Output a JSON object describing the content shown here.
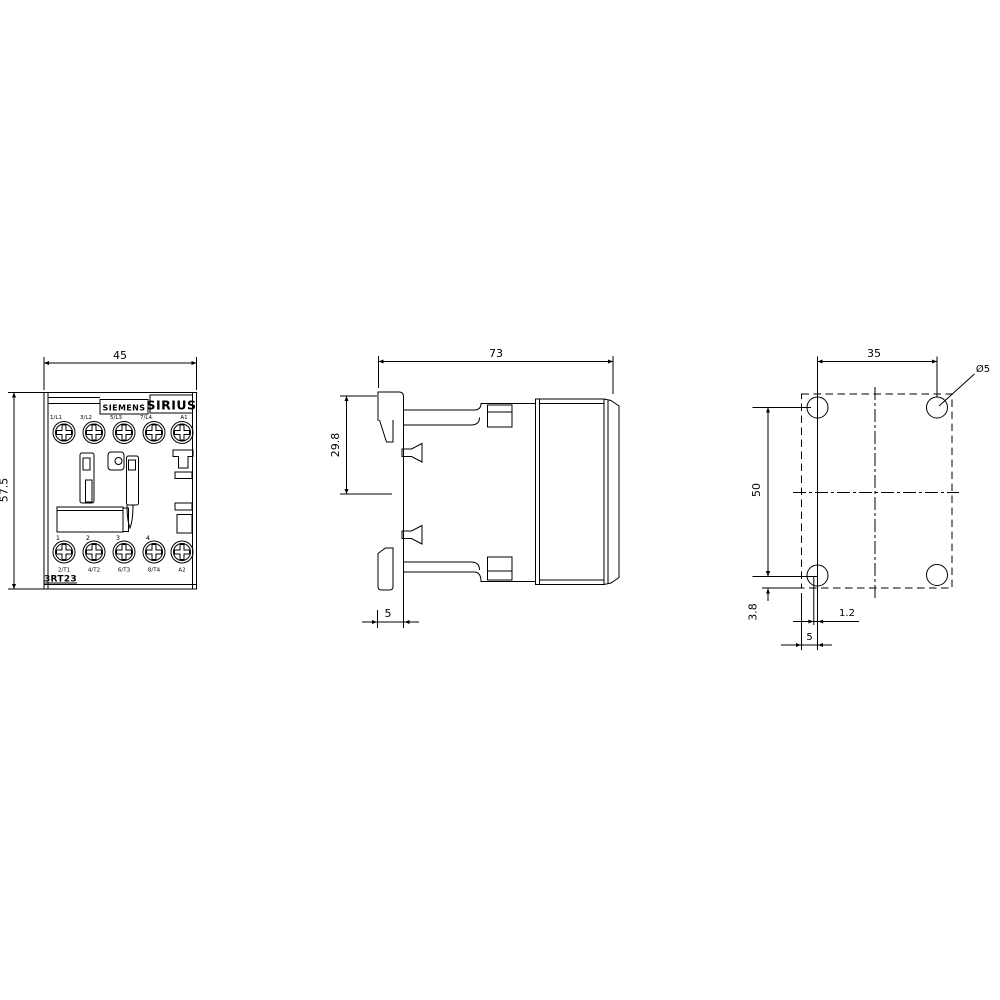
{
  "colors": {
    "background": "#ffffff",
    "line": "#000000"
  },
  "front_view": {
    "dim_width": "45",
    "dim_height": "57.5",
    "brand": "SIEMENS",
    "series": "SIRIUS",
    "model": "3RT23",
    "terminals_top": [
      "1/L1",
      "3/L2",
      "5/L3",
      "7/L4",
      "A1"
    ],
    "pole_numbers": [
      "1",
      "2",
      "3",
      "4"
    ],
    "terminals_bottom": [
      "2/T1",
      "4/T2",
      "6/T3",
      "8/T4",
      "A2"
    ]
  },
  "side_view": {
    "dim_depth": "73",
    "dim_rail": "29.8",
    "dim_clip": "5"
  },
  "drilling_view": {
    "dim_hole_spacing_h": "35",
    "dim_hole_spacing_v": "50",
    "dim_hole_diameter": "Ø5",
    "dim_bottom_offset": "3.8",
    "dim_slot_offset": "1.2",
    "dim_edge_offset": "5"
  }
}
